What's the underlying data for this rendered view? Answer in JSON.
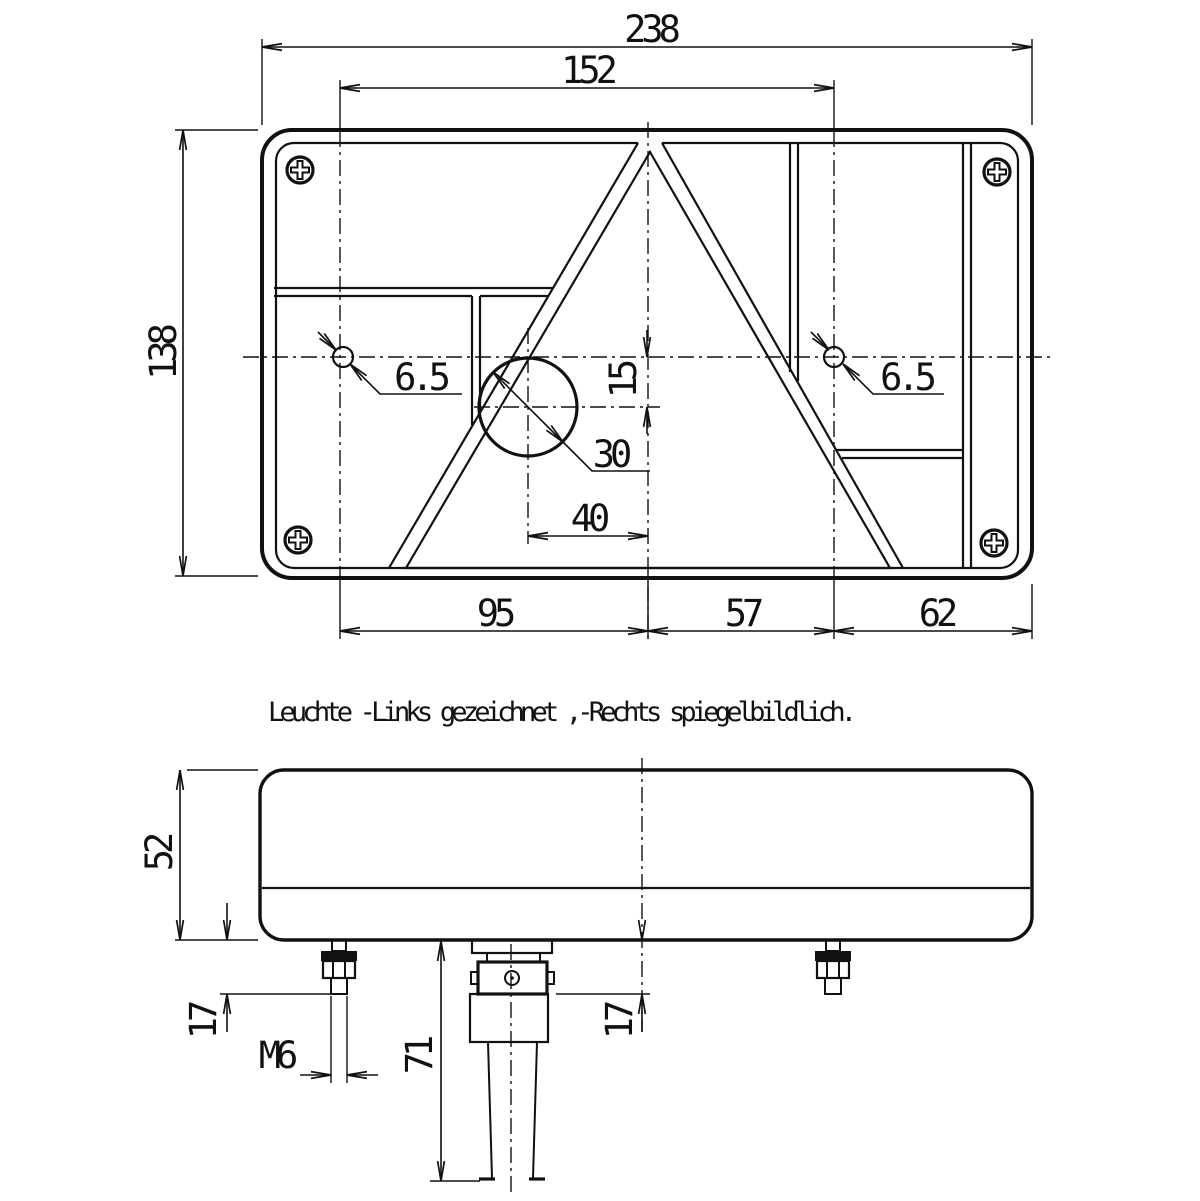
{
  "note": {
    "text": "Leuchte -Links gezeichnet ,-Rechts spiegelbildlich."
  },
  "front_view": {
    "dim_width_total": "238",
    "dim_hole_spacing": "152",
    "dim_height": "138",
    "dim_hole_left": "6.5",
    "dim_hole_right": "6.5",
    "dim_center_offset": "15",
    "dim_bulb_hole_dia": "30",
    "dim_bulb_hole_x": "40",
    "dim_left_span": "95",
    "dim_mid_span": "57",
    "dim_right_span": "62"
  },
  "side_view": {
    "dim_depth": "52",
    "dim_stud_protrusion": "17",
    "thread_label": "M6",
    "dim_cable_length": "71",
    "dim_connector_protrusion": "17"
  }
}
